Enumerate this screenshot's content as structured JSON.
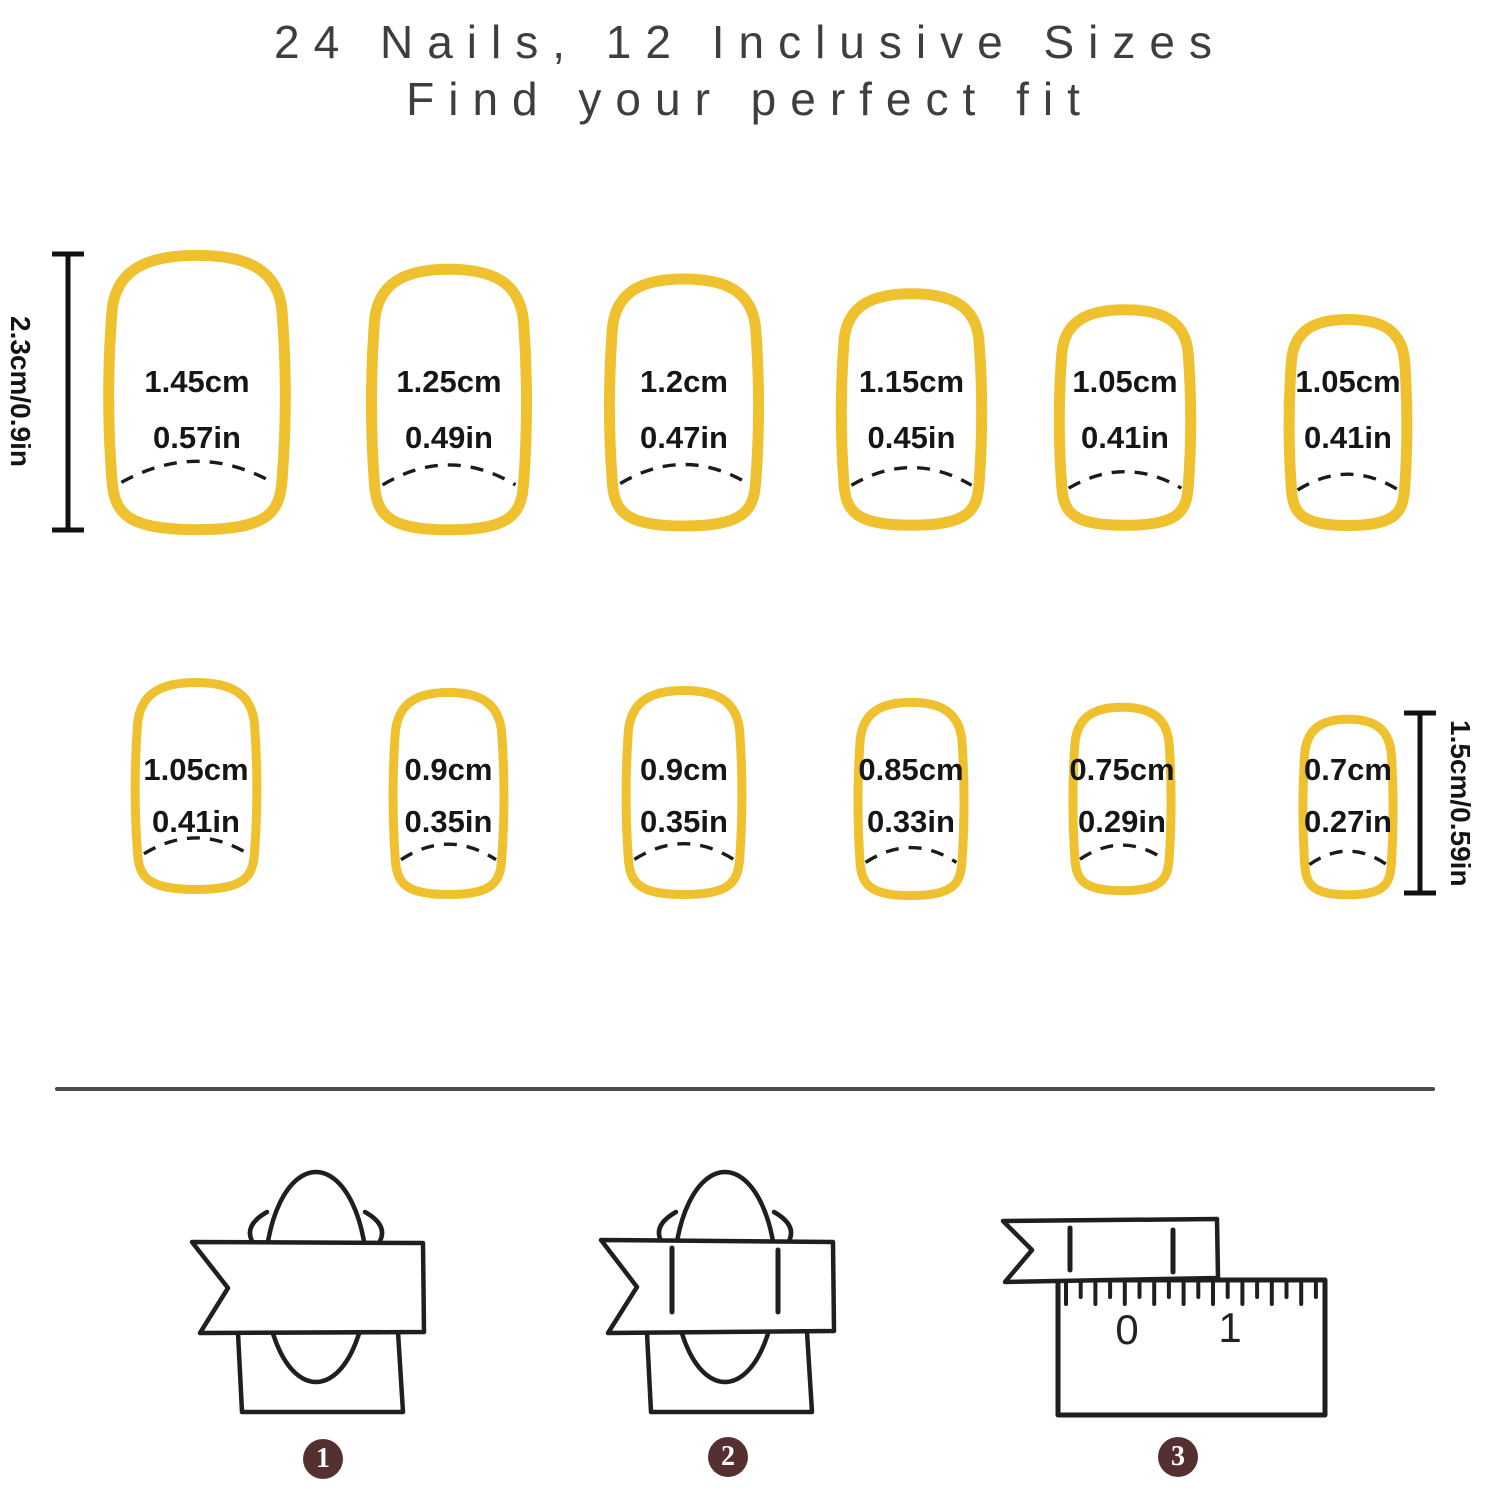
{
  "title": {
    "line1": "24 Nails, 12 Inclusive Sizes",
    "line2": "Find your perfect fit"
  },
  "colors": {
    "nail_outline": "#efc12f",
    "label_text": "#161616",
    "title_text": "#3e3e3e",
    "ruler_black": "#111111",
    "divider": "#4c4c4c",
    "diagram_stroke": "#1f1f1f",
    "badge_bg": "#543130",
    "badge_text": "#ffffff"
  },
  "rulers": {
    "left": {
      "label": "2.3cm/0.9in"
    },
    "right": {
      "label": "1.5cm/0.59in"
    }
  },
  "nails": {
    "row1": [
      {
        "cm": "1.45cm",
        "in": "0.57in"
      },
      {
        "cm": "1.25cm",
        "in": "0.49in"
      },
      {
        "cm": "1.2cm",
        "in": "0.47in"
      },
      {
        "cm": "1.15cm",
        "in": "0.45in"
      },
      {
        "cm": "1.05cm",
        "in": "0.41in"
      },
      {
        "cm": "1.05cm",
        "in": "0.41in"
      }
    ],
    "row2": [
      {
        "cm": "1.05cm",
        "in": "0.41in"
      },
      {
        "cm": "0.9cm",
        "in": "0.35in"
      },
      {
        "cm": "0.9cm",
        "in": "0.35in"
      },
      {
        "cm": "0.85cm",
        "in": "0.33in"
      },
      {
        "cm": "0.75cm",
        "in": "0.29in"
      },
      {
        "cm": "0.7cm",
        "in": "0.27in"
      }
    ]
  },
  "measure_ruler": {
    "zero": "0",
    "one": "1"
  },
  "steps": [
    {
      "number": "1"
    },
    {
      "number": "2"
    },
    {
      "number": "3"
    }
  ]
}
